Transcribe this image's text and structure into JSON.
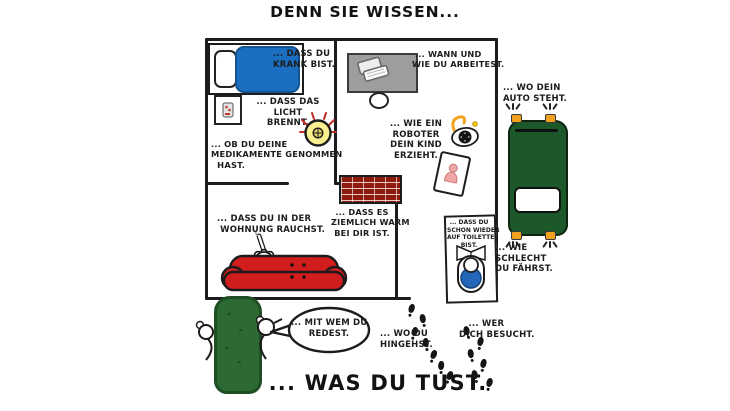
{
  "illustration": {
    "title_top": "DENN SIE WISSEN...",
    "title_bottom": "... WAS DU TUST.",
    "labels": {
      "sick": "... DASS DU\nKRANK BIST.",
      "work": " ... WANN UND\nWIE DU ARBEITEST.",
      "light": "... DASS DAS\nLICHT\nBRENNT.",
      "meds": "... OB DU DEINE\nMEDIKAMENTE GENOMMEN\n  HAST.",
      "robot": "... WIE EIN\nROBOTER\nDEIN KIND\nERZIEHT.",
      "car": "... WO DEIN\nAUTO STEHT.",
      "smoke": "... DASS DU IN DER\n WOHNUNG RAUCHST.",
      "warm": "... DASS ES\nZIEMLICH WARM\nBEI DIR IST.",
      "toilet": "... DASS DU\nSCHON WIEDER\nAUF TOILETTE\nBIST.",
      "drive": "... WIE\nSCHLECHT\nDU FÄHRST.",
      "talk": "... MIT WEM DU\nREDEST.",
      "go": "... WO DU\nHINGEHST.",
      "visit": "   ... WER\nDICH BESUCHT."
    },
    "colors": {
      "ink": "#1c1c1c",
      "bed_blue": "#1b6fc1",
      "couch_red": "#d11d1d",
      "car_green": "#1c582a",
      "hedge_green": "#2d6a33",
      "brick_red": "#8e1b10",
      "bulb_yellow": "#f8ef8e",
      "toilet_blue": "#2467b8",
      "desk_gray": "#9d9d9d",
      "signal_orange": "#f2a01e"
    }
  }
}
